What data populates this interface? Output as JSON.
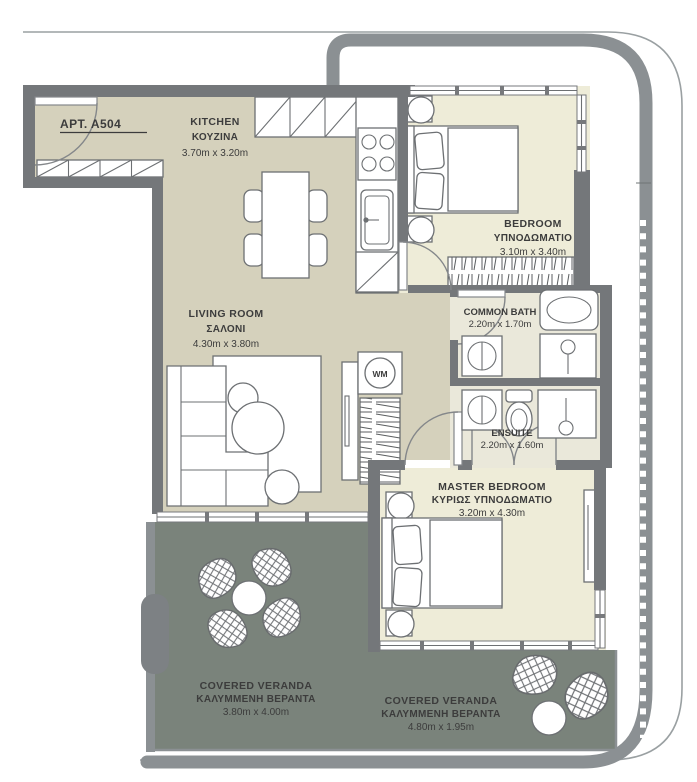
{
  "plan": {
    "apartment_label": "APT. A504",
    "appliances": {
      "washing_machine_label": "WM"
    },
    "rooms": [
      {
        "id": "kitchen",
        "name": "KITCHEN",
        "name_gr": "ΚΟΥΖΙΝΑ",
        "dims": "3.70m x 3.20m"
      },
      {
        "id": "bedroom",
        "name": "BEDROOM",
        "name_gr": "ΥΠΝΟΔΩΜΑΤΙΟ",
        "dims": "3.10m x 3.40m"
      },
      {
        "id": "living_room",
        "name": "LIVING ROOM",
        "name_gr": "ΣΑΛΟΝΙ",
        "dims": "4.30m x 3.80m"
      },
      {
        "id": "common_bath",
        "name": "COMMON BATH",
        "name_gr": "",
        "dims": "2.20m x 1.70m"
      },
      {
        "id": "ensuite",
        "name": "ENSUITE",
        "name_gr": "",
        "dims": "2.20m x 1.60m"
      },
      {
        "id": "master_bedroom",
        "name": "MASTER BEDROOM",
        "name_gr": "ΚΥΡΙΩΣ ΥΠΝΟΔΩΜΑΤΙΟ",
        "dims": "3.20m x 4.30m"
      },
      {
        "id": "veranda_left",
        "name": "COVERED VERANDA",
        "name_gr": "ΚΑΛΥΜΜΕΝΗ ΒΕΡΑΝΤΑ",
        "dims": "3.80m x 4.00m"
      },
      {
        "id": "veranda_right",
        "name": "COVERED VERANDA",
        "name_gr": "ΚΑΛΥΜΜΕΝΗ ΒΕΡΑΝΤΑ",
        "dims": "4.80m x 1.95m"
      }
    ],
    "colors": {
      "wall": "#74777a",
      "floor_main": "#d5d1bc",
      "floor_bedroom": "#eeecd8",
      "floor_bath": "#eae8da",
      "veranda": "#7a837b",
      "balcony_band": "#8b9093",
      "text": "#3c3c3c"
    }
  }
}
